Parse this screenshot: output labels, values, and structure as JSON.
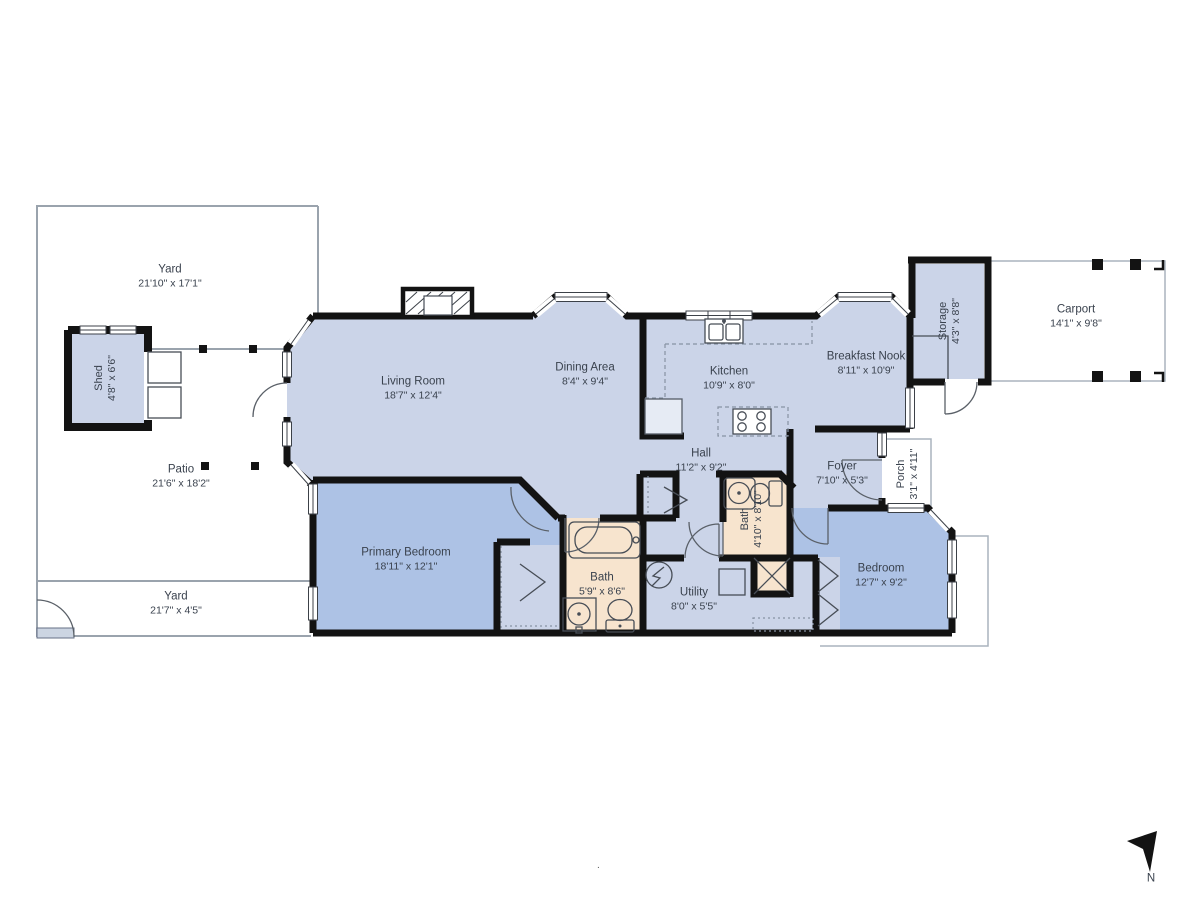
{
  "colors": {
    "wall": "#131313",
    "room": "#cbd4e8",
    "bedroom": "#adc2e5",
    "bath": "#f7e4ce",
    "outline": "#9aa3ad",
    "text": "#3a424e",
    "white": "#ffffff"
  },
  "rooms": [
    {
      "id": "yard-north",
      "name": "Yard",
      "dims": "21'10\" x 17'1\"",
      "rotated": false
    },
    {
      "id": "shed",
      "name": "Shed",
      "dims": "4'8\" x 6'6\"",
      "rotated": true
    },
    {
      "id": "patio",
      "name": "Patio",
      "dims": "21'6\" x 18'2\"",
      "rotated": false
    },
    {
      "id": "yard-south",
      "name": "Yard",
      "dims": "21'7\" x 4'5\"",
      "rotated": false
    },
    {
      "id": "living-room",
      "name": "Living Room",
      "dims": "18'7\" x 12'4\"",
      "rotated": false
    },
    {
      "id": "dining-area",
      "name": "Dining Area",
      "dims": "8'4\" x 9'4\"",
      "rotated": false
    },
    {
      "id": "kitchen",
      "name": "Kitchen",
      "dims": "10'9\" x 8'0\"",
      "rotated": false
    },
    {
      "id": "breakfast-nook",
      "name": "Breakfast Nook",
      "dims": "8'11\" x 10'9\"",
      "rotated": false
    },
    {
      "id": "storage",
      "name": "Storage",
      "dims": "4'3\" x 8'8\"",
      "rotated": true
    },
    {
      "id": "carport",
      "name": "Carport",
      "dims": "14'1\" x 9'8\"",
      "rotated": false
    },
    {
      "id": "hall",
      "name": "Hall",
      "dims": "11'2\" x 9'2\"",
      "rotated": false
    },
    {
      "id": "foyer",
      "name": "Foyer",
      "dims": "7'10\" x 5'3\"",
      "rotated": false
    },
    {
      "id": "porch",
      "name": "Porch",
      "dims": "3'1\" x 4'11\"",
      "rotated": true
    },
    {
      "id": "primary-bedroom",
      "name": "Primary Bedroom",
      "dims": "18'11\" x 12'1\"",
      "rotated": false
    },
    {
      "id": "bath-main",
      "name": "Bath",
      "dims": "5'9\" x 8'6\"",
      "rotated": false
    },
    {
      "id": "utility",
      "name": "Utility",
      "dims": "8'0\" x 5'5\"",
      "rotated": false
    },
    {
      "id": "bath-hall",
      "name": "Bath",
      "dims": "4'10\" x 8'10\"",
      "rotated": true
    },
    {
      "id": "bedroom",
      "name": "Bedroom",
      "dims": "12'7\" x 9'2\"",
      "rotated": false
    }
  ],
  "compass": {
    "label": "N"
  },
  "misc": {
    "dot": "."
  }
}
